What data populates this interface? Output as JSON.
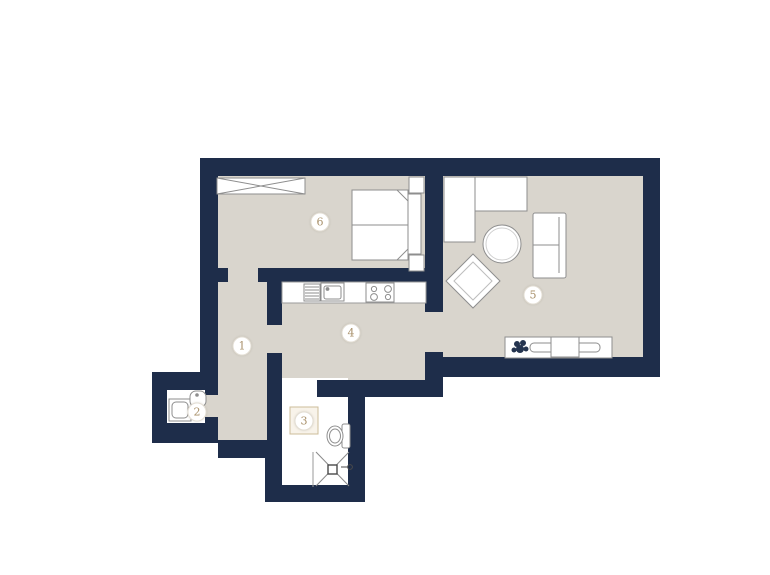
{
  "floorplan": {
    "rooms": [
      {
        "number": "1",
        "name": "hallway"
      },
      {
        "number": "2",
        "name": "wc"
      },
      {
        "number": "3",
        "name": "bathroom"
      },
      {
        "number": "4",
        "name": "kitchen"
      },
      {
        "number": "5",
        "name": "living-room"
      },
      {
        "number": "6",
        "name": "bedroom"
      }
    ],
    "icons": [
      "wardrobe-icon",
      "double-bed-icon",
      "nightstand-icon",
      "corner-sofa-icon",
      "coffee-table-icon",
      "armchair-icon",
      "loveseat-icon",
      "sideboard-icon",
      "tv-icon",
      "plant-icon",
      "dish-rack-icon",
      "kitchen-sink-icon",
      "stove-icon",
      "washing-machine-icon",
      "wc-sink-icon",
      "toilet-icon",
      "shower-icon",
      "shower-head-icon"
    ],
    "colors": {
      "wall": "#1e2d4a",
      "floor": "#d9d5cd",
      "wet_room_floor": "#ffffff",
      "furniture_fill": "#ffffff",
      "furniture_outline": "#8e8e8e",
      "label_text": "#a8906a",
      "label_ring": "#e3ded4",
      "bath_square": "#cdbd9a",
      "background": "#ffffff"
    }
  }
}
